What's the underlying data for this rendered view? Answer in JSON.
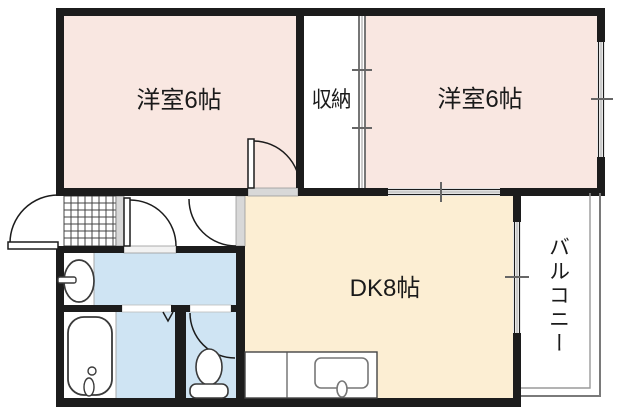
{
  "floor_plan": {
    "rooms": [
      {
        "id": "bedroom-left",
        "label": "洋室6帖"
      },
      {
        "id": "storage",
        "label": "収納"
      },
      {
        "id": "bedroom-right",
        "label": "洋室6帖"
      },
      {
        "id": "dining-kitchen",
        "label": "DK8帖"
      },
      {
        "id": "balcony",
        "label": "バルコニー"
      }
    ],
    "fixtures": [
      "entrance-door",
      "genkan-tiles",
      "washbasin",
      "bathtub",
      "folding-door-mark",
      "toilet",
      "kitchen-sink",
      "sliding-doors",
      "windows"
    ],
    "colors": {
      "wall": "#1c1c1c",
      "bedroom_fill": "#f9e7e1",
      "dk_fill": "#fceed3",
      "wet_area_fill": "#cfe4f3",
      "threshold_gray": "#d8d8d8",
      "railing_gray": "#7a7a7a"
    }
  }
}
